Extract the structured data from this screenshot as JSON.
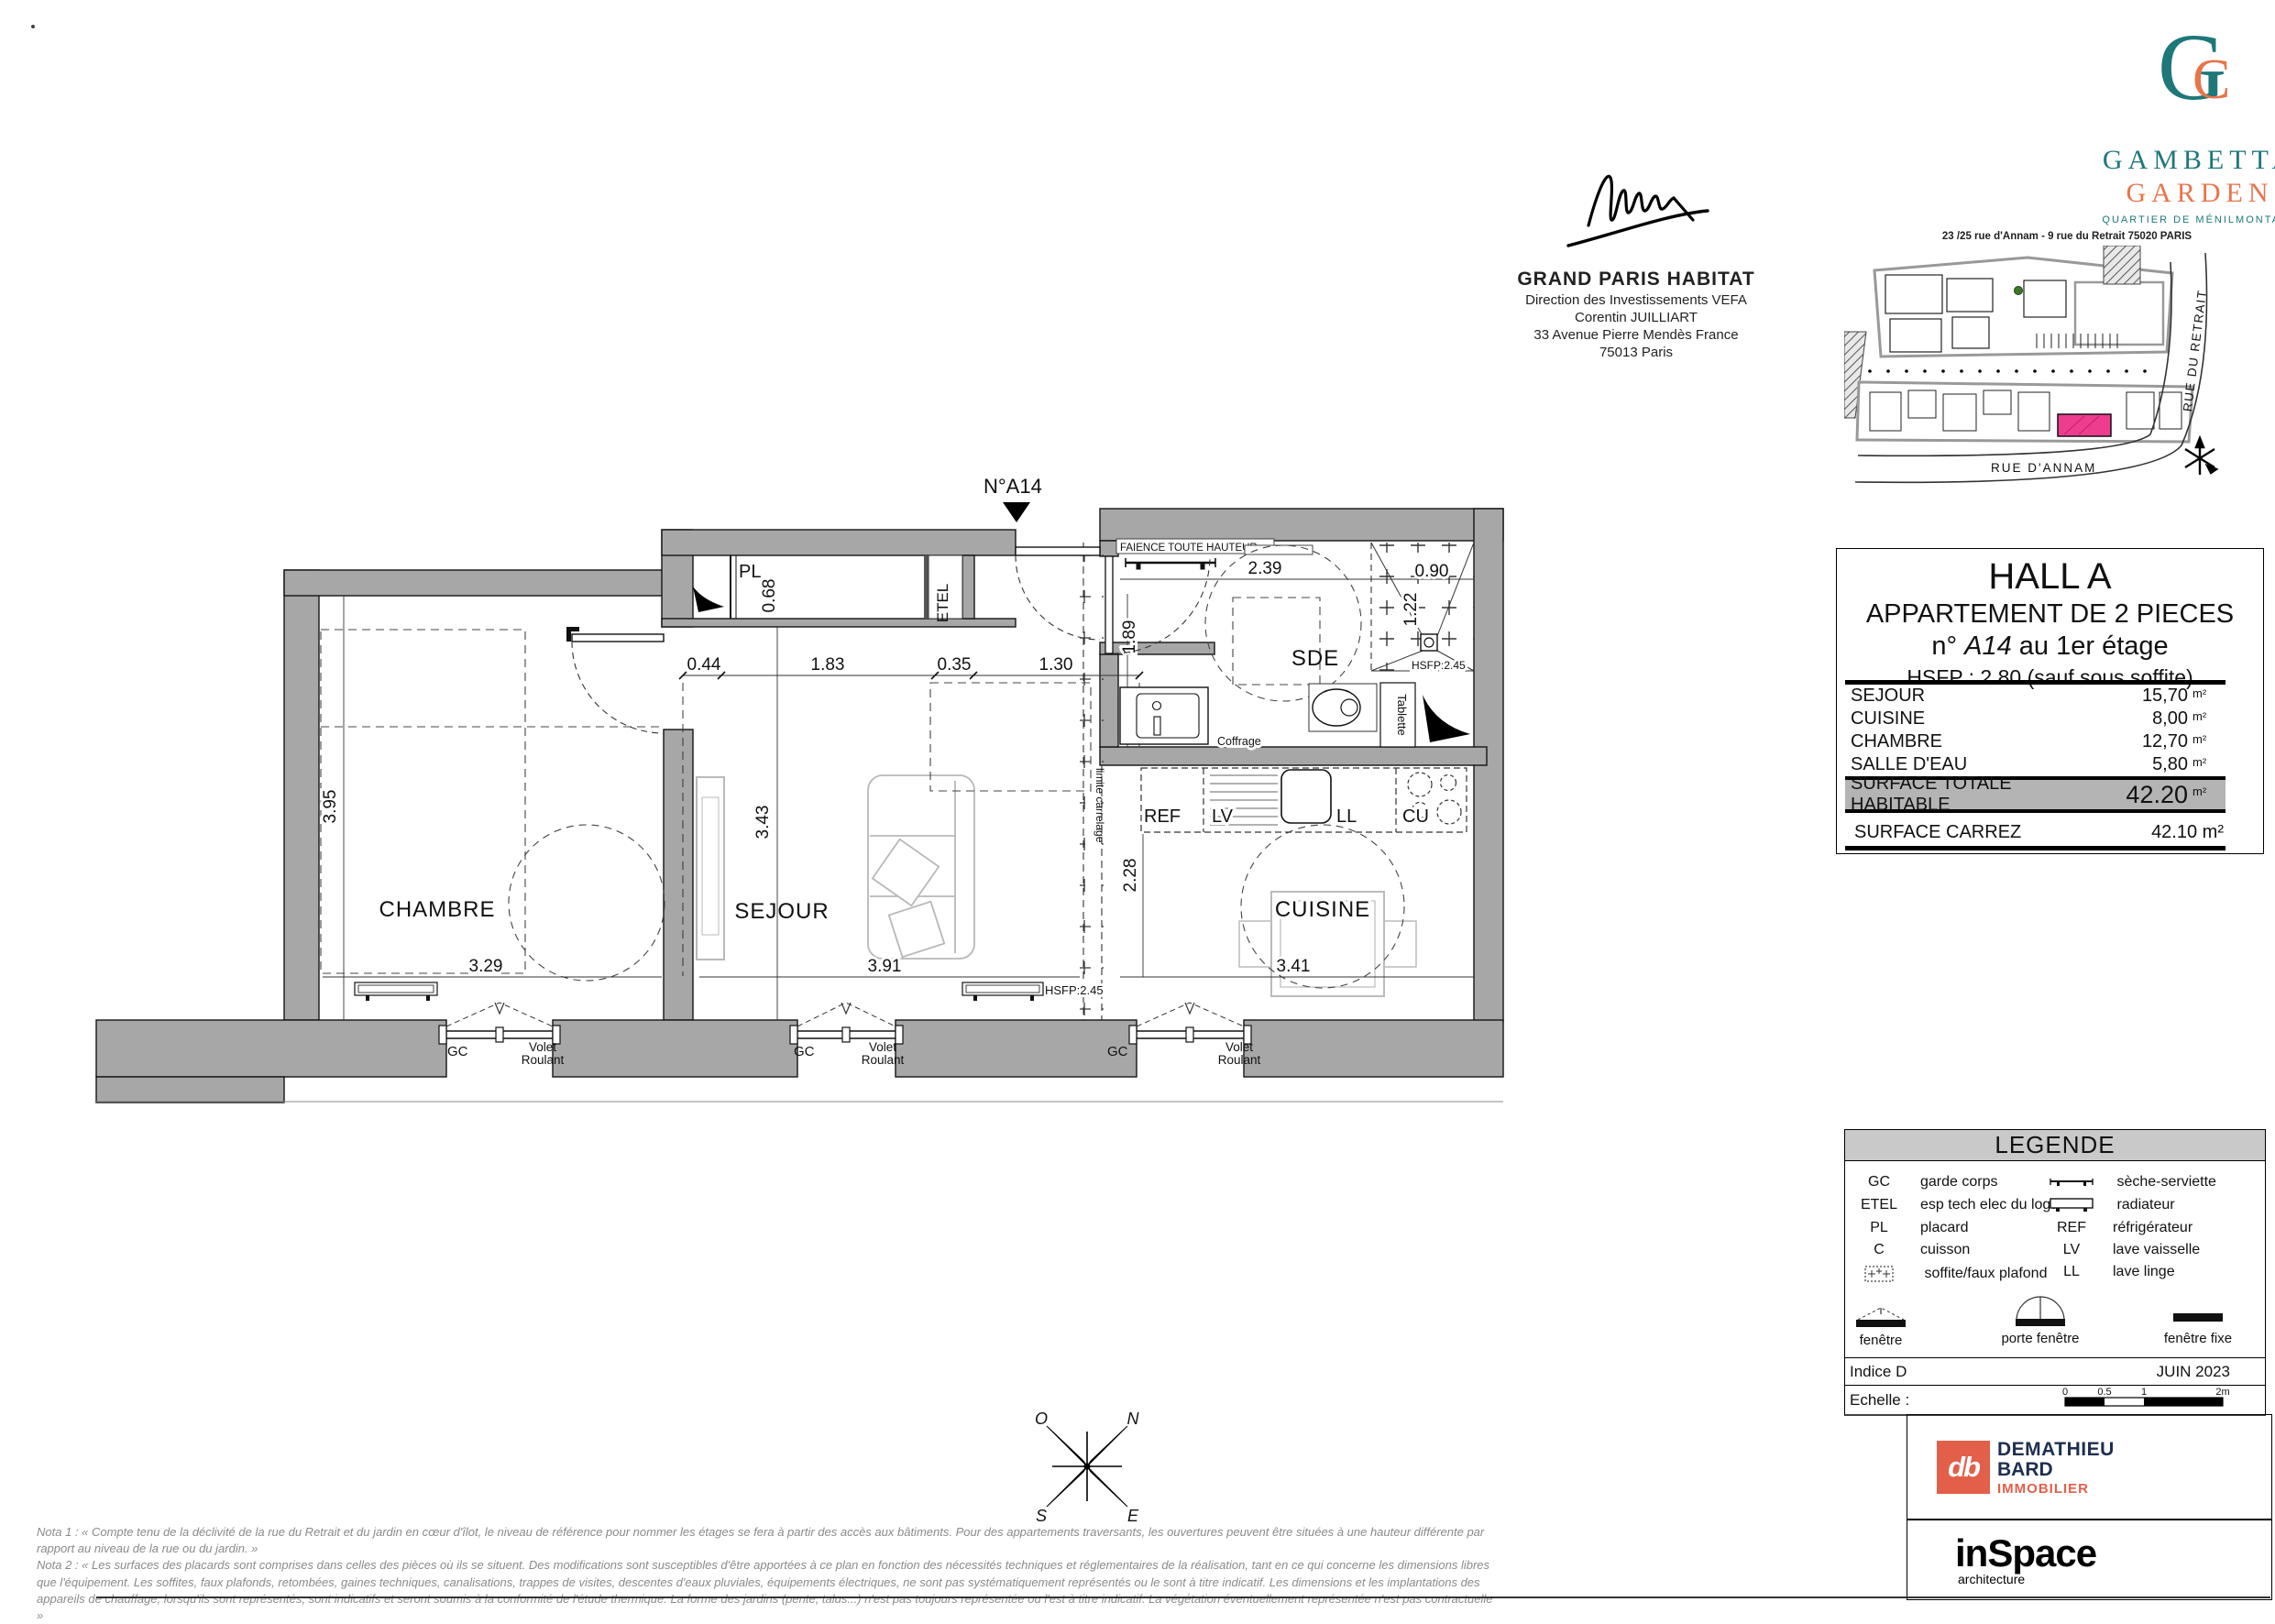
{
  "branding": {
    "monogram_g": "G",
    "monogram_c": "C",
    "name_line1": "GAMBETTA",
    "name_line2": "GARDEN",
    "tagline": "QUARTIER DE MÉNILMONTANT",
    "address": "23 /25 rue d'Annam - 9 rue du Retrait 75020 PARIS",
    "teal": "#1E7779",
    "orange": "#E8744B",
    "pink": "#EE3D8F"
  },
  "developer": {
    "name": "GRAND PARIS HABITAT",
    "dept": "Direction des Investissements VEFA",
    "contact": "Corentin JUILLIART",
    "address1": "33 Avenue Pierre Mendès France",
    "address2": "75013 Paris"
  },
  "site": {
    "street_vertical": "RUE DU RETRAIT",
    "street_horizontal": "RUE D'ANNAM"
  },
  "info": {
    "hall": "HALL A",
    "apt_type": "APPARTEMENT DE 2 PIECES",
    "unit_prefix": "n°",
    "unit_number": "A14",
    "unit_floor": "au 1er étage",
    "hsfp": "HSFP : 2.80 (sauf sous soffite)",
    "rows": [
      {
        "label": "SEJOUR",
        "value": "15,70",
        "unit": "m²"
      },
      {
        "label": "CUISINE",
        "value": "8,00",
        "unit": "m²"
      },
      {
        "label": "CHAMBRE",
        "value": "12,70",
        "unit": "m²"
      },
      {
        "label": "SALLE D'EAU",
        "value": "5,80",
        "unit": "m²"
      }
    ],
    "total": {
      "label": "SURFACE TOTALE HABITABLE",
      "value": "42.20",
      "unit": "m²"
    },
    "carrez": {
      "label": "SURFACE CARREZ",
      "value": "42.10 m²"
    }
  },
  "plan": {
    "marker": "N°A14",
    "labels": {
      "chambre": "CHAMBRE",
      "sejour": "SEJOUR",
      "sde": "SDE",
      "cuisine": "CUISINE",
      "pl": "PL",
      "etel": "ETEL",
      "ref": "REF",
      "lv": "LV",
      "ll": "LL",
      "cu": "CU",
      "faience": "FAIENCE TOUTE HAUTEUR",
      "coffrage": "Coffrage",
      "tablette": "Tablette",
      "limite_carrelage": "limite carrelage",
      "hsfp_245": "HSFP:2.45",
      "gc": "GC",
      "volet_line1": "Volet",
      "volet_line2": "Roulant"
    },
    "dims": {
      "chambre_w": "3.29",
      "chambre_h": "3.95",
      "sejour_w": "3.91",
      "sejour_h": "3.43",
      "cuisine_w": "3.41",
      "cuisine_h": "2.28",
      "sde_w": "2.39",
      "sde_h": "1.89",
      "shower_w": "0.90",
      "shower_h": "1.22",
      "pl_h": "0.68",
      "hall": [
        "0.44",
        "1.83",
        "0.35",
        "1.30"
      ]
    },
    "compass": {
      "n": "N",
      "s": "S",
      "e": "E",
      "o": "O"
    }
  },
  "legend": {
    "title": "LEGENDE",
    "left": [
      {
        "abbr": "GC",
        "label": "garde corps"
      },
      {
        "abbr": "ETEL",
        "label": "esp tech elec  du logt"
      },
      {
        "abbr": "PL",
        "label": "placard"
      },
      {
        "abbr": "C",
        "label": "cuisson"
      },
      {
        "abbr": "",
        "label": "soffite/faux plafond"
      }
    ],
    "right": [
      {
        "abbr": "",
        "label": "sèche-serviette"
      },
      {
        "abbr": "",
        "label": "radiateur"
      },
      {
        "abbr": "REF",
        "label": "réfrigérateur"
      },
      {
        "abbr": "LV",
        "label": "lave vaisselle"
      },
      {
        "abbr": "LL",
        "label": "lave linge"
      }
    ],
    "windows": [
      {
        "label": "fenêtre"
      },
      {
        "label": "porte fenêtre"
      },
      {
        "label": "fenêtre fixe"
      }
    ],
    "indice": "Indice D",
    "date": "JUIN 2023",
    "echelle_label": "Echelle :",
    "scale_ticks": [
      "0",
      "0.5",
      "1",
      "2m"
    ]
  },
  "footer": {
    "dmb": {
      "monogram": "db",
      "line1": "DEMATHIEU",
      "line2": "BARD",
      "line3": "IMMOBILIER"
    },
    "inspace": {
      "name": "inSpace",
      "tagline": "architecture"
    }
  },
  "notes": {
    "nota1": "Nota 1 : « Compte tenu de la déclivité de la rue du Retrait et du jardin en cœur d'îlot, le niveau de référence pour nommer les étages se fera à partir des accès aux bâtiments. Pour des appartements traversants, les ouvertures peuvent être situées à une hauteur différente par rapport au niveau de la rue ou du jardin. »",
    "nota2": "Nota 2 : « Les surfaces des placards sont comprises dans celles des pièces où ils se situent. Des modifications sont susceptibles d'être apportées à ce plan en fonction des nécessités techniques et réglementaires de la réalisation, tant en ce qui concerne les dimensions libres que l'équipement. Les soffites, faux plafonds, retombées, gaines techniques, canalisations, trappes de visites, descentes d'eaux pluviales, équipements électriques, ne sont pas systématiquement représentés ou le sont à titre indicatif. Les dimensions et les implantations des appareils de chauffage, lorsqu'ils sont représentés, sont indicatifs et seront soumis à la conformité de l'étude thermique. La forme des jardins (pente, talus...) n'est pas toujours représentée ou l'est à titre indicatif. La végétation éventuellement représentée n'est pas contractuelle »"
  }
}
